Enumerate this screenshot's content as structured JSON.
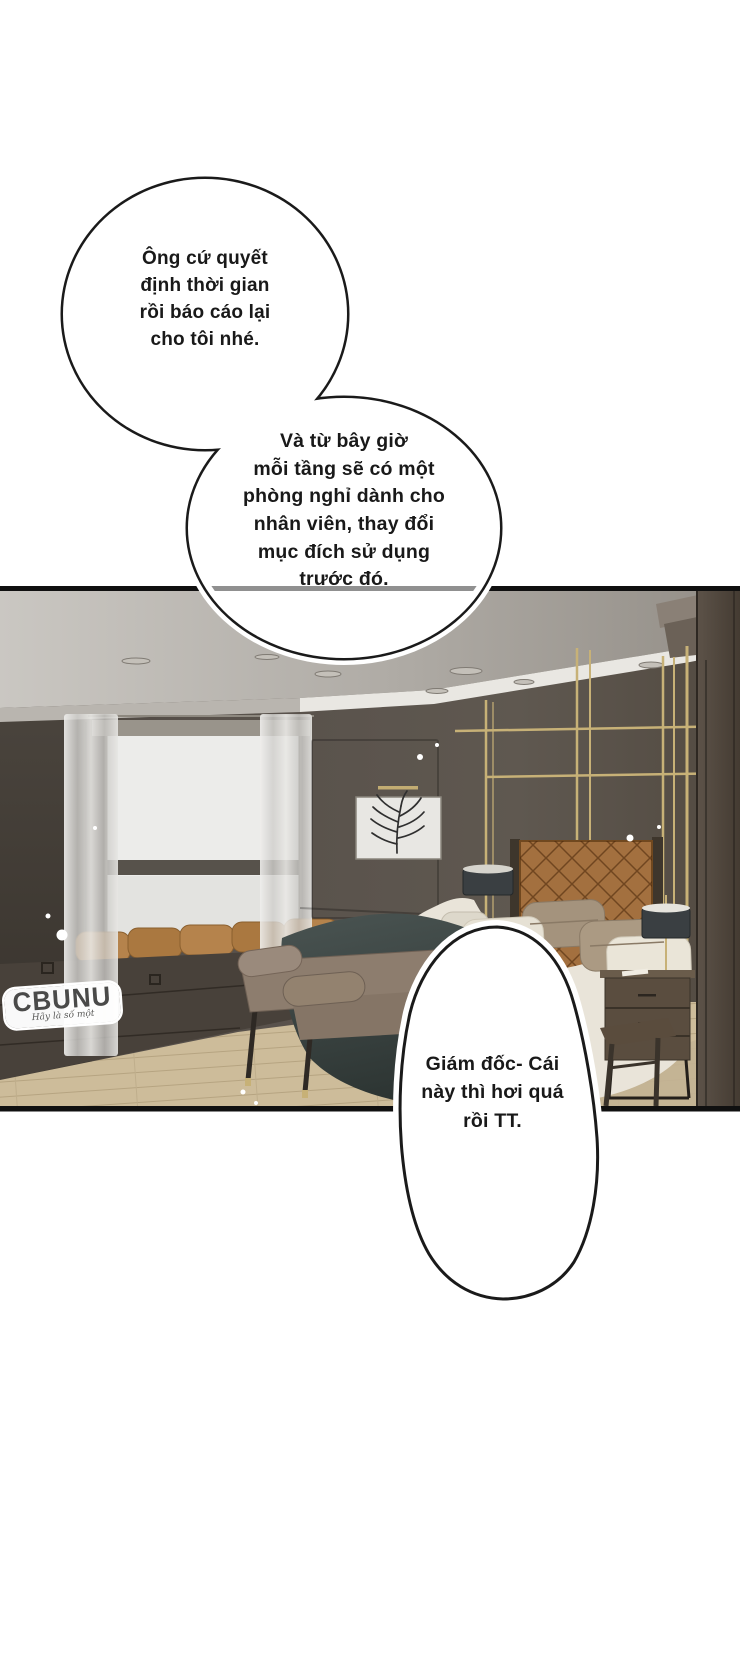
{
  "page": {
    "width": 740,
    "height": 1663,
    "background_color": "#ffffff"
  },
  "speech_bubbles": [
    {
      "id": "bubble-1",
      "text": "Ông cứ quyết\nđịnh thời gian\nrồi báo cáo lại\ncho tôi nhé."
    },
    {
      "id": "bubble-2",
      "text": "Và từ bây giờ\nmỗi tầng sẽ có một\nphòng nghỉ dành cho\nnhân viên, thay đổi\nmục đích sử dụng\ntrước đó."
    },
    {
      "id": "bubble-3",
      "text": "Giám đốc- Cái\nnày thì hơi quá\nrồi TT."
    }
  ],
  "watermark": {
    "brand": "CBUNU",
    "tagline": "Hãy là số một"
  },
  "panel": {
    "colors": {
      "panel_border": "#101010",
      "wall": "#57504a",
      "ceiling": "#b5b1ab",
      "cove_light": "#e9e7e2",
      "window_glow": "#ececea",
      "curtain": "#dcdbd8",
      "gold_accent": "#c7b177",
      "headboard_leather": "#a3703f",
      "bed_sheets": "#e9e4d9",
      "blanket": "#3a4442",
      "pillow_taupe": "#a4937d",
      "bench_upholstery": "#8f7f70",
      "wood_floor": "#cdbc9a",
      "nightstand_wood": "#5a4d3f",
      "pillar": "#4f463c",
      "bubble_fill": "#ffffff",
      "bubble_stroke": "#1a1a1a",
      "text": "#191919",
      "watermark_text": "#4a4a49"
    }
  }
}
